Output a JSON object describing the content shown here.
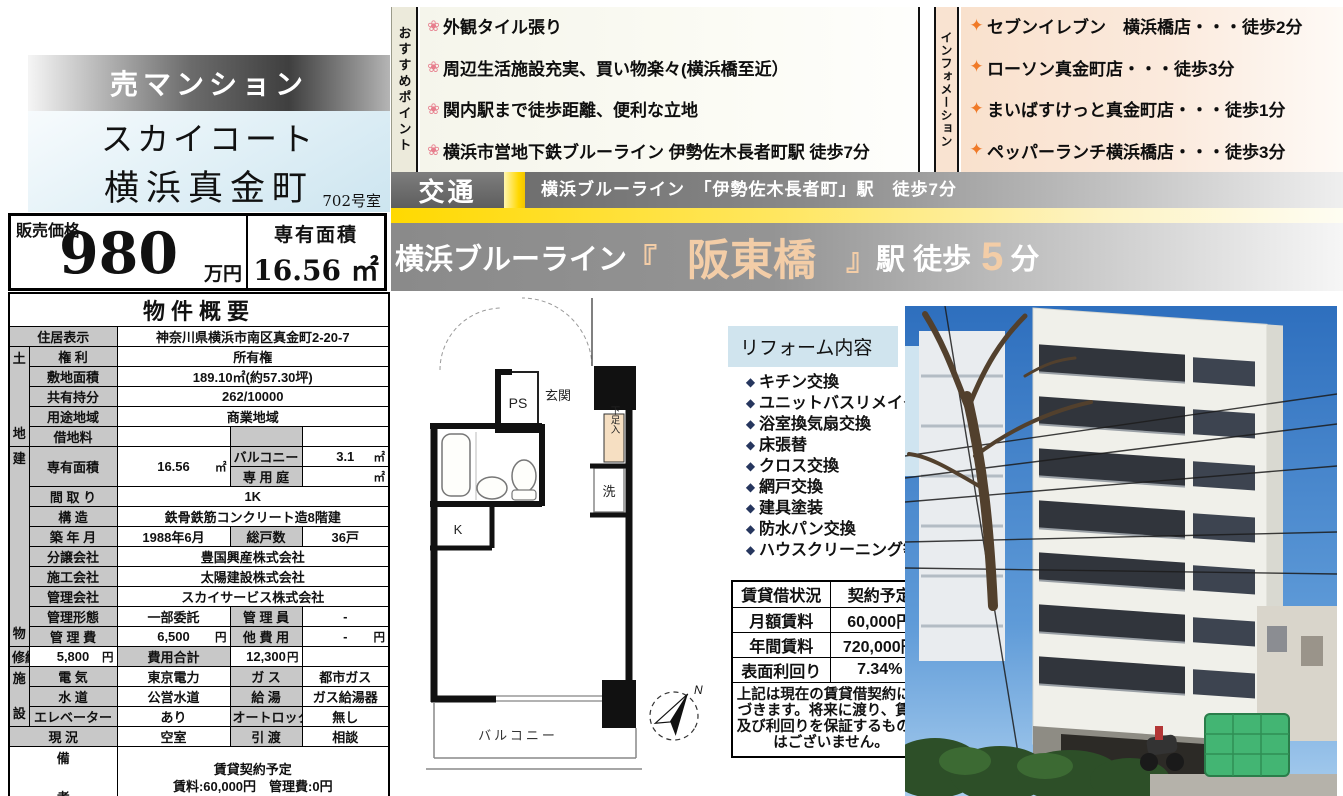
{
  "header": {
    "sale_type": "売マンション",
    "building_name_line1": "スカイコート",
    "building_name_line2": "横浜真金町",
    "room": "702号室",
    "price_label": "販売価格",
    "price_value": "980",
    "price_unit": "万円",
    "area_label": "専有面積",
    "area_value": "16.56 ㎡"
  },
  "recommend": {
    "label": "おすすめポイント",
    "items": [
      "外観タイル張り",
      "周辺生活施設充実、買い物楽々(横浜橋至近）",
      "関内駅まで徒歩距離、便利な立地",
      "横浜市営地下鉄ブルーライン 伊勢佐木長者町駅 徒歩7分"
    ]
  },
  "information": {
    "label": "インフォメーション",
    "items": [
      "セブンイレブン　横浜橋店・・・徒歩2分",
      "ローソン真金町店・・・徒歩3分",
      "まいばすけっと真金町店・・・徒歩1分",
      "ペッパーランチ横浜橋店・・・徒歩3分"
    ]
  },
  "transport": {
    "label": "交通",
    "line": "横浜ブルーライン　「伊勢佐木長者町」駅　徒歩7分",
    "station_prefix": "横浜ブルーライン",
    "bracket_open": "『",
    "station_name": "阪東橋",
    "bracket_close": "』",
    "station_suffix": "駅 徒歩",
    "station_minutes": "5",
    "station_min_unit": "分"
  },
  "overview": {
    "title": "物件概要",
    "rows": [
      {
        "cells": [
          {
            "t": "住居表示",
            "c": "l",
            "cs": 2
          },
          {
            "t": "神奈川県横浜市南区真金町2-20-7",
            "c": "v",
            "cs": 3
          }
        ]
      },
      {
        "cells": [
          {
            "t": "土地",
            "c": "g",
            "rs": 5
          },
          {
            "t": "権 利",
            "c": "l"
          },
          {
            "t": "所有権",
            "c": "v",
            "cs": 3
          }
        ]
      },
      {
        "cells": [
          {
            "t": "敷地面積",
            "c": "l"
          },
          {
            "t": "189.10㎡(約57.30坪)",
            "c": "v",
            "cs": 3
          }
        ]
      },
      {
        "cells": [
          {
            "t": "共有持分",
            "c": "l"
          },
          {
            "t": "262/10000",
            "c": "v",
            "cs": 3
          }
        ]
      },
      {
        "cells": [
          {
            "t": "用途地域",
            "c": "l"
          },
          {
            "t": "商業地域",
            "c": "v",
            "cs": 3
          }
        ]
      },
      {
        "cells": [
          {
            "t": "借地料",
            "c": "l"
          },
          {
            "t": "",
            "c": "v"
          },
          {
            "t": "",
            "c": "l"
          },
          {
            "t": "",
            "c": "v"
          }
        ]
      },
      {
        "cells": [
          {
            "t": "建物",
            "c": "g",
            "rs": 10
          },
          {
            "t": "専有面積",
            "c": "l",
            "rs": 2
          },
          {
            "t": "16.56",
            "u": "㎡",
            "c": "v",
            "rs": 2
          },
          {
            "t": "バルコニー",
            "c": "l"
          },
          {
            "t": "3.1",
            "u": "㎡",
            "c": "v"
          }
        ]
      },
      {
        "cells": [
          {
            "t": "専 用 庭",
            "c": "l"
          },
          {
            "t": "",
            "u": "㎡",
            "c": "v"
          }
        ]
      },
      {
        "cells": [
          {
            "t": "間 取 り",
            "c": "l"
          },
          {
            "t": "1K",
            "c": "v",
            "cs": 3
          }
        ]
      },
      {
        "cells": [
          {
            "t": "構 造",
            "c": "l"
          },
          {
            "t": "鉄骨鉄筋コンクリート造8階建",
            "c": "v",
            "cs": 3
          }
        ]
      },
      {
        "cells": [
          {
            "t": "築 年 月",
            "c": "l"
          },
          {
            "t": "1988年6月",
            "c": "v"
          },
          {
            "t": "総戸数",
            "c": "l"
          },
          {
            "t": "36戸",
            "c": "v"
          }
        ]
      },
      {
        "cells": [
          {
            "t": "分譲会社",
            "c": "l"
          },
          {
            "t": "豊国興産株式会社",
            "c": "v",
            "cs": 3
          }
        ]
      },
      {
        "cells": [
          {
            "t": "施工会社",
            "c": "l"
          },
          {
            "t": "太陽建設株式会社",
            "c": "v",
            "cs": 3
          }
        ]
      },
      {
        "cells": [
          {
            "t": "管理会社",
            "c": "l"
          },
          {
            "t": "スカイサービス株式会社",
            "c": "v",
            "cs": 3
          }
        ]
      },
      {
        "cells": [
          {
            "t": "管理形態",
            "c": "l"
          },
          {
            "t": "一部委託",
            "c": "v"
          },
          {
            "t": "管 理 員",
            "c": "l"
          },
          {
            "t": "-",
            "c": "v"
          }
        ]
      },
      {
        "cells": [
          {
            "t": "管 理 費",
            "c": "l"
          },
          {
            "t": "6,500",
            "u": "円",
            "c": "v"
          },
          {
            "t": "他 費 用",
            "c": "l"
          },
          {
            "t": "-",
            "u": "円",
            "c": "v"
          }
        ]
      },
      {
        "cells": [
          {
            "t": "修繕積立金",
            "c": "l"
          },
          {
            "t": "5,800",
            "u": "円",
            "c": "v"
          },
          {
            "t": "費用合計",
            "c": "l"
          },
          {
            "t": "12,300",
            "u": "円",
            "c": "v"
          }
        ]
      },
      {
        "cells": [
          {
            "t": "施設",
            "c": "g",
            "rs": 3
          },
          {
            "t": "電 気",
            "c": "l"
          },
          {
            "t": "東京電力",
            "c": "v"
          },
          {
            "t": "ガ ス",
            "c": "l"
          },
          {
            "t": "都市ガス",
            "c": "v"
          }
        ]
      },
      {
        "cells": [
          {
            "t": "水 道",
            "c": "l"
          },
          {
            "t": "公営水道",
            "c": "v"
          },
          {
            "t": "給 湯",
            "c": "l"
          },
          {
            "t": "ガス給湯器",
            "c": "v"
          }
        ]
      },
      {
        "cells": [
          {
            "t": "エレベーター",
            "c": "l"
          },
          {
            "t": "あり",
            "c": "v"
          },
          {
            "t": "オートロック",
            "c": "l"
          },
          {
            "t": "無し",
            "c": "v"
          }
        ]
      },
      {
        "cells": [
          {
            "t": "現 況",
            "c": "l",
            "cs": 2
          },
          {
            "t": "空室",
            "c": "v"
          },
          {
            "t": "引 渡",
            "c": "l"
          },
          {
            "t": "相談",
            "c": "v"
          }
        ]
      },
      {
        "cells": [
          {
            "t": "備考",
            "c": "gv",
            "cs": 2
          },
          {
            "lines": [
              "賃貸契約予定",
              "賃料:60,000円　管理費:0円"
            ],
            "c": "v",
            "cs": 3
          }
        ]
      }
    ]
  },
  "reform": {
    "title": "リフォーム内容",
    "items": [
      "キチン交換",
      "ユニットバスリメイク",
      "浴室換気扇交換",
      "床張替",
      "クロス交換",
      "網戸交換",
      "建具塗装",
      "防水パン交換",
      "ハウスクリーニング等"
    ]
  },
  "rental": {
    "rows": [
      [
        "賃貸借状況",
        "契約予定"
      ],
      [
        "月額賃料",
        "60,000円"
      ],
      [
        "年間賃料",
        "720,000円"
      ],
      [
        "表面利回り",
        "7.34%"
      ]
    ],
    "note": "上記は現在の賃貸借契約に基づきます。将来に渡り、賃料及び利回りを保証するものではございません。"
  },
  "floorplan": {
    "ps": "PS",
    "entrance": "玄関",
    "shoe_box": "下足入",
    "washer": "洗",
    "kitchen": "K",
    "balcony": "バルコニー",
    "north": "N"
  },
  "colors": {
    "accent_peach": "#f3cda7",
    "yellow_stripe": "#ffd900",
    "reform_header_bg": "#d0e4ee",
    "label_gray": "#c8c8c8"
  }
}
